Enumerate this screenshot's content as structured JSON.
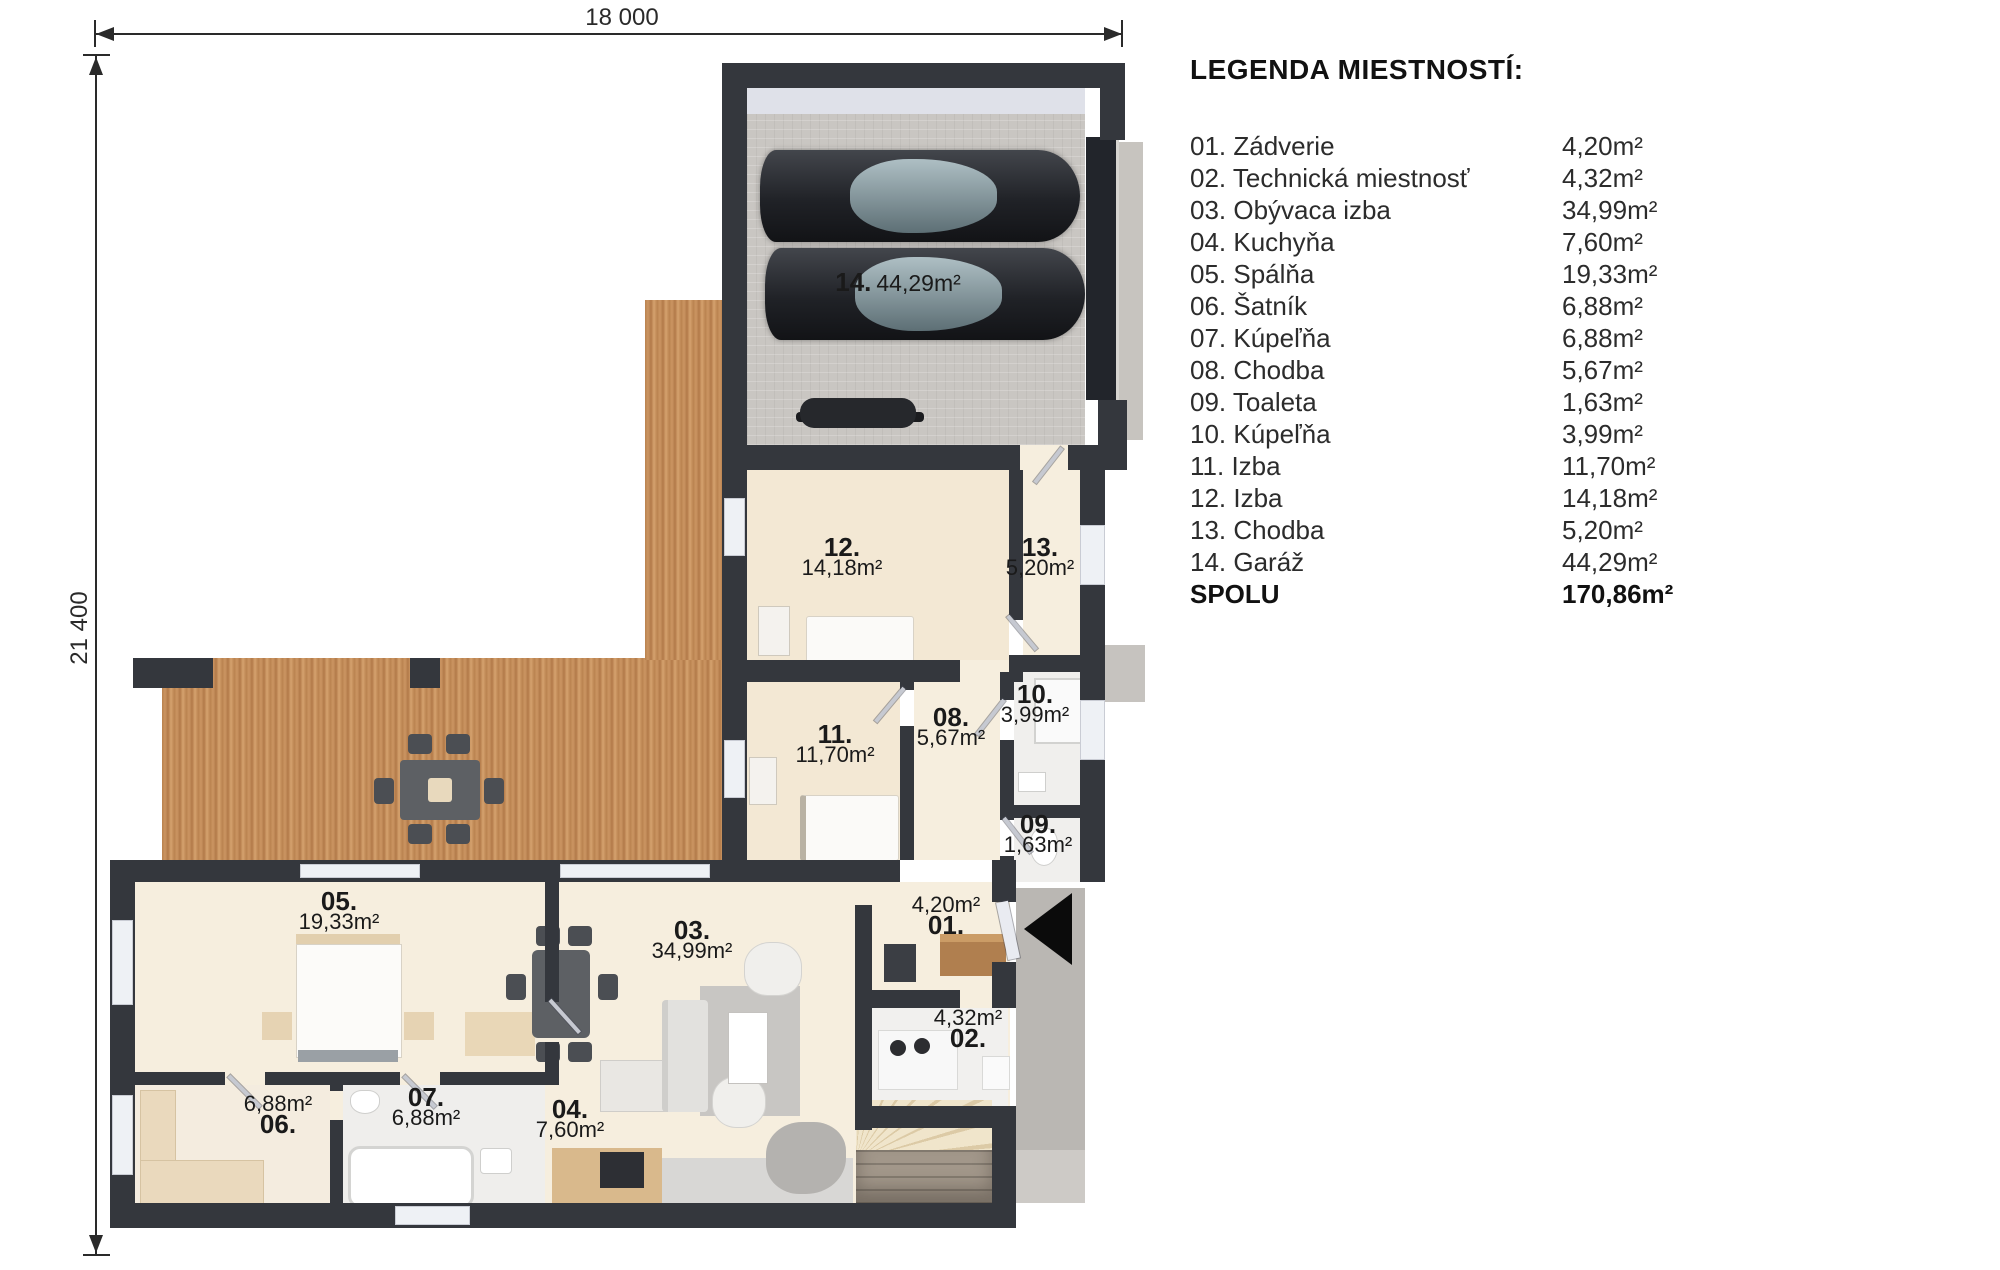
{
  "dimensions": {
    "top_label": "18 000",
    "left_label": "21 400"
  },
  "legend": {
    "title": "LEGENDA MIESTNOSTÍ:",
    "rows": [
      {
        "name": "01. Zádverie",
        "area": "4,20m²"
      },
      {
        "name": "02. Technická miestnosť",
        "area": "4,32m²"
      },
      {
        "name": "03. Obývaca izba",
        "area": "34,99m²"
      },
      {
        "name": "04. Kuchyňa",
        "area": "7,60m²"
      },
      {
        "name": "05. Spálňa",
        "area": "19,33m²"
      },
      {
        "name": "06. Šatník",
        "area": "6,88m²"
      },
      {
        "name": "07. Kúpeľňa",
        "area": "6,88m²"
      },
      {
        "name": "08. Chodba",
        "area": "5,67m²"
      },
      {
        "name": "09. Toaleta",
        "area": "1,63m²"
      },
      {
        "name": "10. Kúpeľňa",
        "area": "3,99m²"
      },
      {
        "name": "11. Izba",
        "area": "11,70m²"
      },
      {
        "name": "12. Izba",
        "area": "14,18m²"
      },
      {
        "name": "13. Chodba",
        "area": "5,20m²"
      },
      {
        "name": "14. Garáž",
        "area": "44,29m²"
      },
      {
        "name": "SPOLU",
        "area": "170,86m²"
      }
    ]
  },
  "plan": {
    "room_labels": [
      {
        "id": "14",
        "number": "14.",
        "area": "44,29m²"
      },
      {
        "id": "12",
        "number": "12.",
        "area": "14,18m²"
      },
      {
        "id": "13",
        "number": "13.",
        "area": "5,20m²"
      },
      {
        "id": "10",
        "number": "10.",
        "area": "3,99m²"
      },
      {
        "id": "08",
        "number": "08.",
        "area": "5,67m²"
      },
      {
        "id": "11",
        "number": "11.",
        "area": "11,70m²"
      },
      {
        "id": "09",
        "number": "09.",
        "area": "1,63m²"
      },
      {
        "id": "05",
        "number": "05.",
        "area": "19,33m²"
      },
      {
        "id": "03",
        "number": "03.",
        "area": "34,99m²"
      },
      {
        "id": "01",
        "number": "01.",
        "area": "4,20m²"
      },
      {
        "id": "02",
        "number": "02.",
        "area": "4,32m²"
      },
      {
        "id": "06",
        "number": "06.",
        "area": "6,88m²"
      },
      {
        "id": "07",
        "number": "07.",
        "area": "6,88m²"
      },
      {
        "id": "04",
        "number": "04.",
        "area": "7,60m²"
      }
    ],
    "colors": {
      "wall": "#34373d",
      "terrace_wood": "#c08b5a",
      "interior_floor": "#f6eede",
      "garage_floor": "#c9c6c2",
      "walkway": "#bab7b3"
    }
  }
}
